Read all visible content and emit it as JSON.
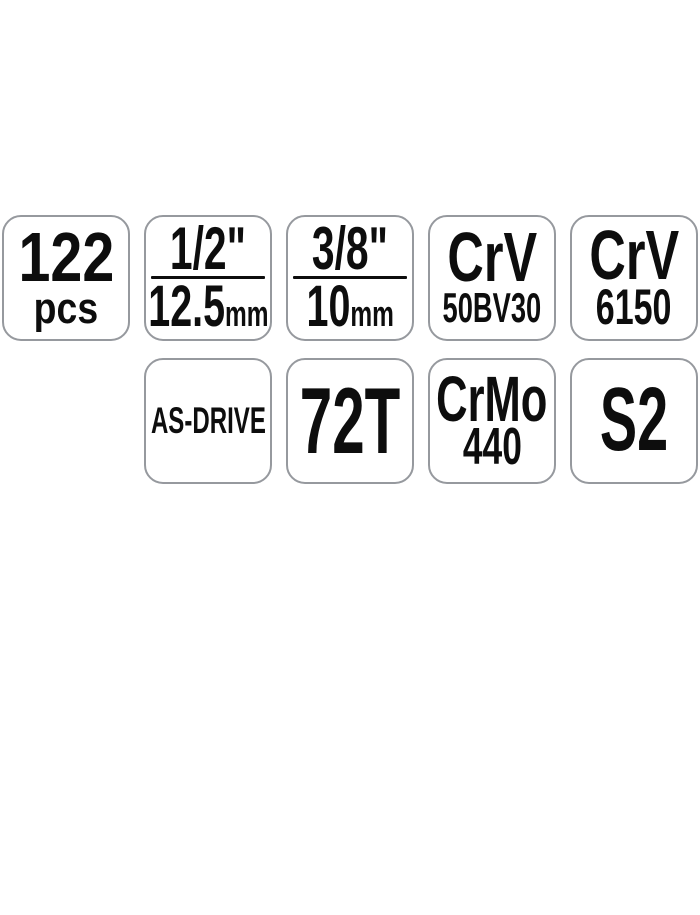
{
  "colors": {
    "page_bg": "#ffffff",
    "badge_bg": "#ffffff",
    "badge_border": "#96999e",
    "text": "#0d0d0d"
  },
  "badges": {
    "row1": [
      {
        "id": "pieces",
        "line1": "122",
        "line2": "pcs"
      },
      {
        "id": "drive-1-2",
        "top": "1/2\"",
        "bottom": "12.5",
        "unit": "mm"
      },
      {
        "id": "drive-3-8",
        "top": "3/8\"",
        "bottom": "10",
        "unit": "mm"
      },
      {
        "id": "crv-50bv30",
        "line1": "CrV",
        "line2": "50BV30"
      },
      {
        "id": "crv-6150",
        "line1": "CrV",
        "line2": "6150"
      }
    ],
    "row2": [
      {
        "id": "as-drive",
        "line1": "AS-DRIVE"
      },
      {
        "id": "72t",
        "line1": "72T"
      },
      {
        "id": "crmo-440",
        "line1": "CrMo",
        "line2": "440"
      },
      {
        "id": "s2",
        "line1": "S2"
      }
    ]
  }
}
